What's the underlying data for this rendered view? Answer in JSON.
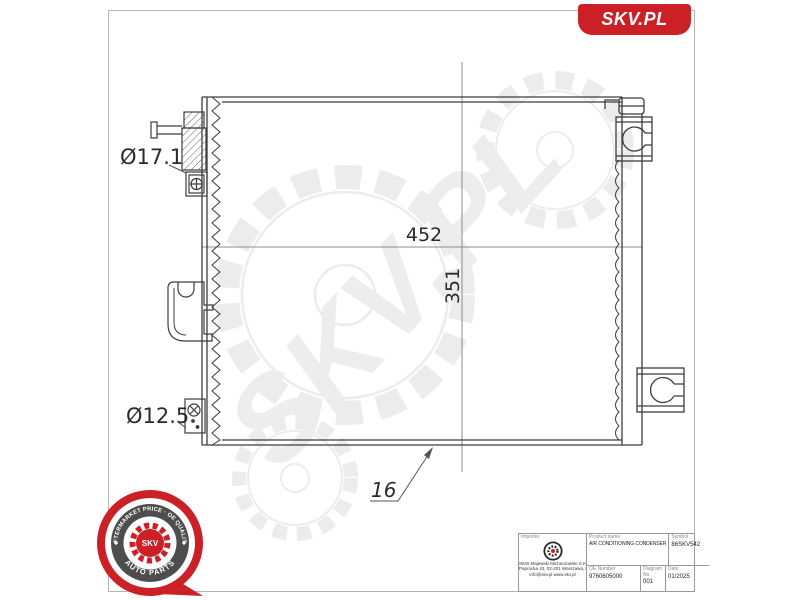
{
  "brand": {
    "logo_text": "SKV.PL"
  },
  "watermark": {
    "text": "SKV.PL"
  },
  "colors": {
    "brand_red": "#cb2026",
    "badge_ring_gray": "#4d4d4d",
    "drawing_line": "#3c3c3c",
    "dim_line": "#8c8c8c",
    "watermark_gray": "#ededed"
  },
  "drawing": {
    "inlet_diameter": "Ø17.1",
    "outlet_diameter": "Ø12.5",
    "core_width": "452",
    "core_height": "351",
    "core_thickness": "16"
  },
  "badge": {
    "arc_top": "AFTERMARKET PRICE · OE QUALITY",
    "arc_bottom": "AUTO PARTS",
    "center_text": "SKV"
  },
  "title_block": {
    "importer_label": "Importer",
    "company_lines": [
      "SKW Majewski Michnorowski S.K.A.",
      "Paprocka 43, 02-201 Warszawa, Poland",
      "info@skv.pl  www.skv.pl"
    ],
    "product_name_label": "Product name",
    "product_name": "AIR CONDITIONING CONDENSER",
    "symbol_label": "Symbol",
    "symbol": "86SKV542",
    "oe_number_label": "OE Number",
    "oe_number": "9760605000",
    "diagram_label": "Diagram No.",
    "diagram_no": "001",
    "date_label": "Date",
    "date": "01/2025"
  }
}
